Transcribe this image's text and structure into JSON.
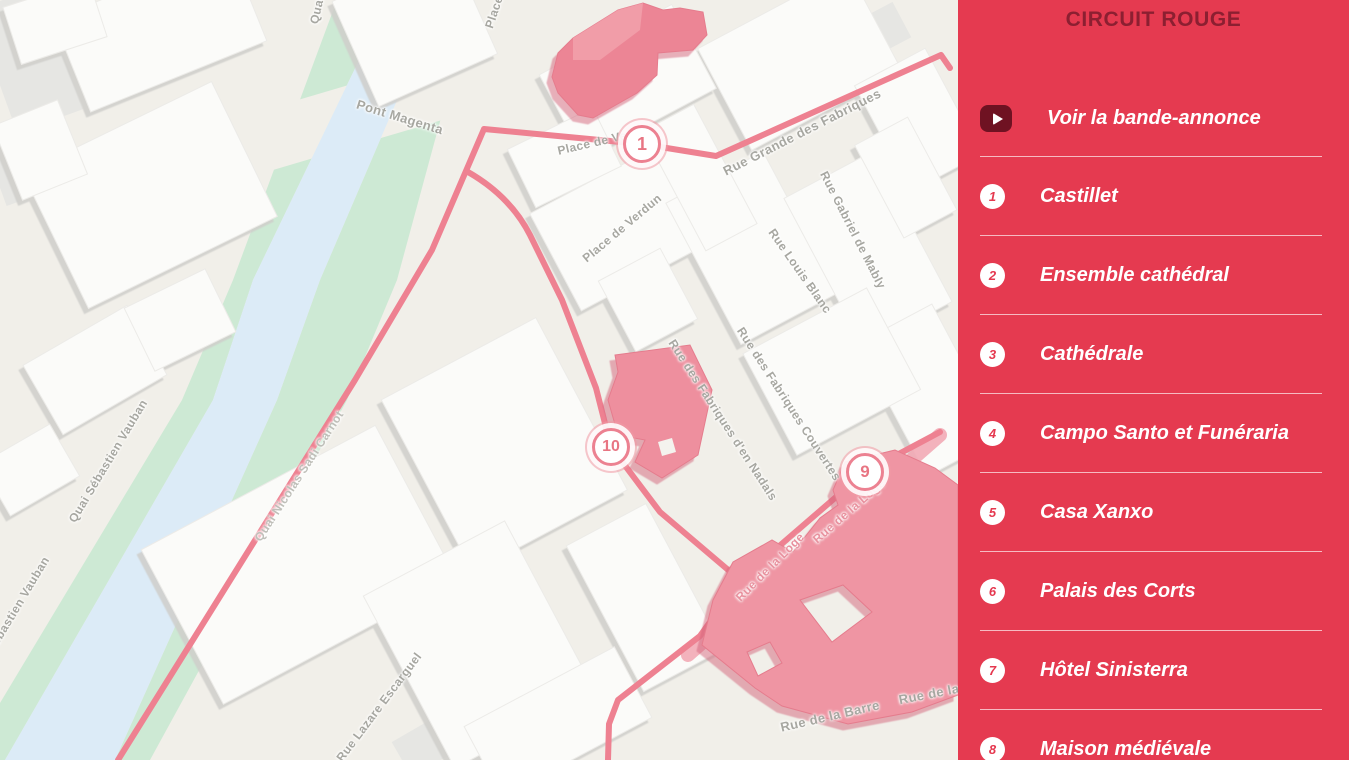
{
  "sidebar": {
    "title": "CIRCUIT ROUGE",
    "trailer": {
      "label": "Voir la bande-annonce",
      "icon": "play-icon"
    },
    "items": [
      {
        "number": "1",
        "label": "Castillet"
      },
      {
        "number": "2",
        "label": "Ensemble cathédral"
      },
      {
        "number": "3",
        "label": "Cathédrale"
      },
      {
        "number": "4",
        "label": "Campo Santo et Funéraria"
      },
      {
        "number": "5",
        "label": "Casa Xanxo"
      },
      {
        "number": "6",
        "label": "Palais des Corts"
      },
      {
        "number": "7",
        "label": "Hôtel Sinisterra"
      },
      {
        "number": "8",
        "label": "Maison médiévale"
      }
    ],
    "colors": {
      "background": "#e53a50",
      "title": "#8c1f31",
      "play_button": "#6f1222",
      "item_text": "#ffffff"
    }
  },
  "map": {
    "markers": [
      {
        "number": "1",
        "x": 642,
        "y": 144
      },
      {
        "number": "10",
        "x": 611,
        "y": 447
      },
      {
        "number": "9",
        "x": 865,
        "y": 472
      }
    ],
    "street_labels": [
      {
        "text": "Pont Magenta"
      },
      {
        "text": "Quai"
      },
      {
        "text": "Place"
      },
      {
        "text": "Place de Ve"
      },
      {
        "text": "Place de Verdun"
      },
      {
        "text": "Rue Grande des Fabriques"
      },
      {
        "text": "Rue Gabriel de Mably"
      },
      {
        "text": "Rue Louis Blanc"
      },
      {
        "text": "Rue des Fabriques d'en Nadals"
      },
      {
        "text": "Rue des Fabriques Couvertes"
      },
      {
        "text": "Rue de la Loge"
      },
      {
        "text": "Rue de la Loge"
      },
      {
        "text": "Rue de la Barre"
      },
      {
        "text": "Rue de la"
      },
      {
        "text": "Quai Sébastien Vauban"
      },
      {
        "text": "Quai Sébastien Vauban"
      },
      {
        "text": "Quai Nicolas Sadi Carnot"
      },
      {
        "text": "Rue Lazare Escarguel"
      }
    ],
    "colors": {
      "background": "#f1efe9",
      "water": "#dcebf7",
      "park": "#cde9d4",
      "route": "#ee8191",
      "highlight_building": "#ee8c9b"
    }
  }
}
